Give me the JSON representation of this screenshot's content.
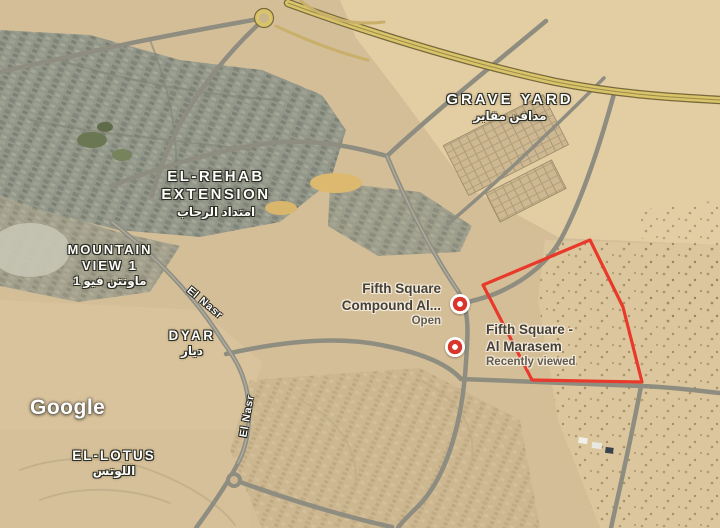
{
  "map": {
    "attribution_logo": "Google",
    "area_labels": {
      "grave_yard": {
        "en": "GRAVE YARD",
        "ar": "مدافن مقابر"
      },
      "el_rehab_extension": {
        "line1": "EL-REHAB",
        "line2": "EXTENSION",
        "ar": "امتداد الرحاب"
      },
      "mountain_view_1": {
        "line1": "MOUNTAIN",
        "line2": "VIEW 1",
        "ar": "ماونتن فيو 1"
      },
      "dyar": {
        "en": "DYAR",
        "ar": "ديار"
      },
      "el_lotus": {
        "en": "EL-LOTUS",
        "ar": "اللوتس"
      }
    },
    "road_labels": {
      "el_nasr_upper": "El Nasr",
      "el_nasr_lower": "El Nasr"
    },
    "places": {
      "fifth_square_compound": {
        "name_line1": "Fifth Square",
        "name_line2": "Compound Al...",
        "status": "Open"
      },
      "fifth_square_al_marasem": {
        "name_line1": "Fifth Square -",
        "name_line2": "Al Marasem",
        "status": "Recently viewed"
      }
    },
    "colors": {
      "plot_outline": "#E8392B",
      "pin_red": "#D9352A",
      "highway_yellow": "#D9C469"
    }
  }
}
